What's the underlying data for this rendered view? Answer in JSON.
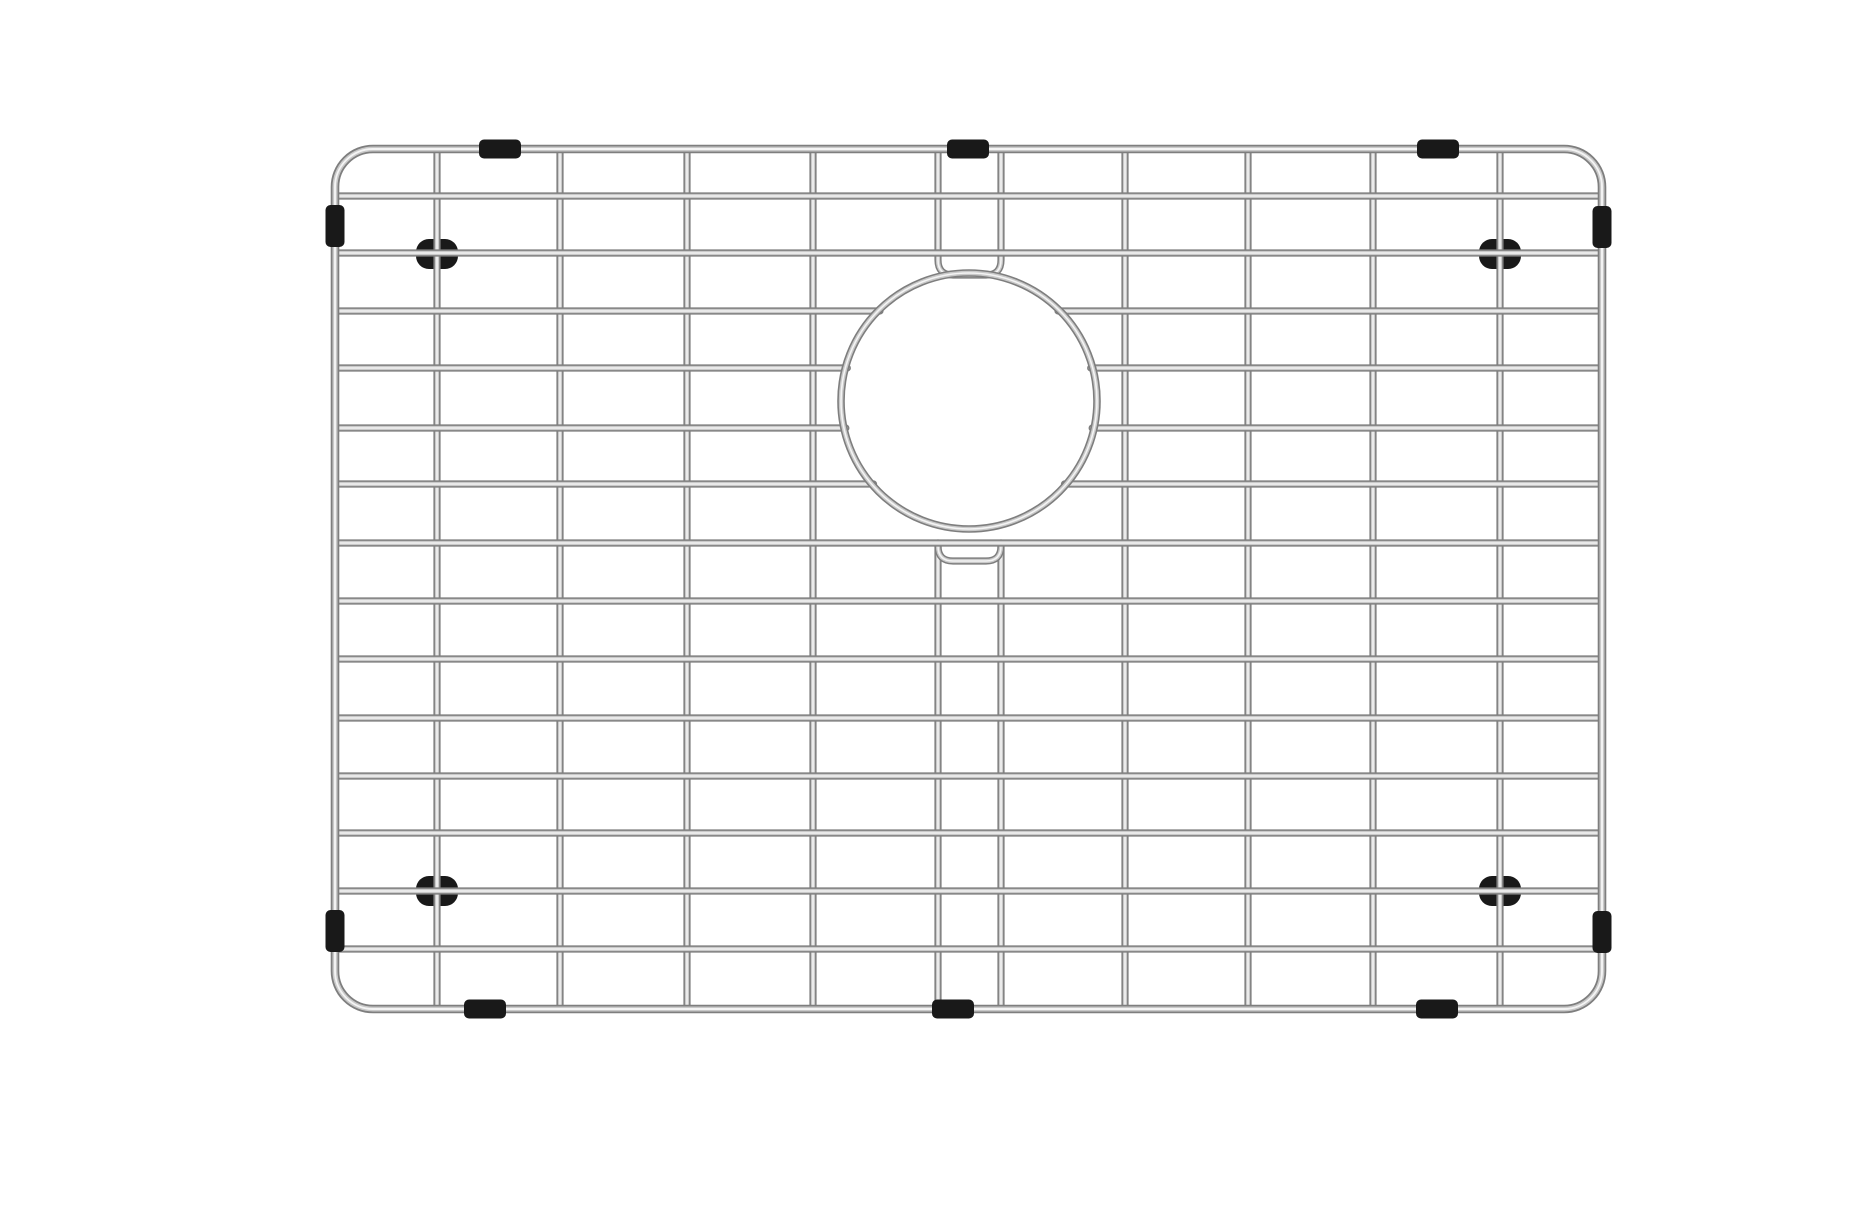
{
  "scene": {
    "type": "product-photo",
    "subject": "stainless-steel wire sink bottom grid with circular drain opening, rubber feet and edge bumpers",
    "background": "#ffffff"
  },
  "canvas": {
    "width": 1864,
    "height": 1200
  },
  "colors": {
    "wire_edge": "#7e7e7e",
    "wire_mid": "#c9c9c9",
    "wire_highlight": "#f4f4f4",
    "rubber_black": "#191919"
  },
  "frame": {
    "left": 295,
    "top": 133,
    "right": 1562,
    "bottom": 993,
    "corner_radius": 38
  },
  "grid": {
    "vertical_wires_x": [
      397,
      520,
      647,
      773,
      1085,
      1208,
      1333,
      1460
    ],
    "split_pair_x": [
      898,
      961
    ],
    "horizontal_wires_y": [
      180,
      237,
      295,
      352,
      412,
      468,
      527,
      585,
      643,
      702,
      760,
      817,
      875,
      933
    ],
    "interrupted_rows_y": [
      295,
      352,
      412,
      468
    ]
  },
  "drain_opening": {
    "cx": 929,
    "cy": 385,
    "radius": 128,
    "top_dip": {
      "from_row_y": 237,
      "depth_y": 259
    },
    "bottom_dip": {
      "from_row_y": 527,
      "depth_y": 545
    }
  },
  "bumpers": {
    "top_edge_x": [
      460,
      928,
      1398
    ],
    "bottom_edge_x": [
      445,
      913,
      1397
    ],
    "left_edge_y": [
      210,
      915
    ],
    "right_edge_y": [
      211,
      916
    ],
    "sleeve_length": 42,
    "sleeve_thickness": 19,
    "sleeve_corner_radius": 5
  },
  "feet": {
    "positions": [
      [
        397,
        238
      ],
      [
        1460,
        238
      ],
      [
        397,
        875
      ],
      [
        1460,
        875
      ]
    ],
    "width": 42,
    "height": 30,
    "corner_radius": 13
  }
}
